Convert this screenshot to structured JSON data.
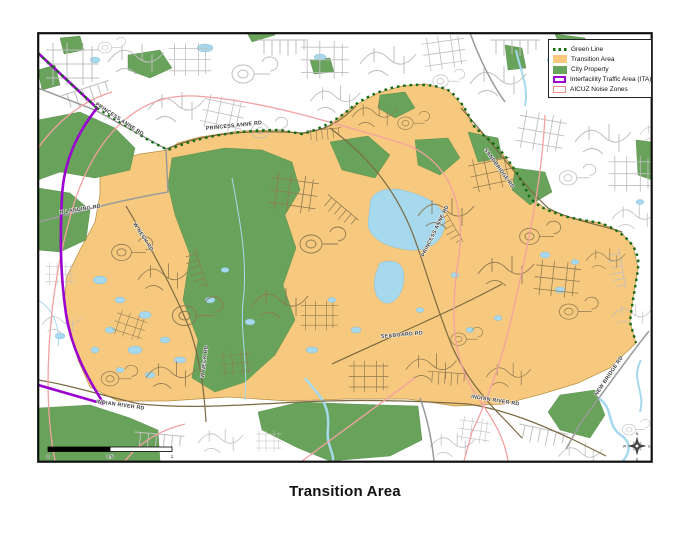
{
  "title": "Transition Area",
  "legend": {
    "items": [
      {
        "label": "Green Line",
        "type": "dotted-line",
        "color": "#146b14"
      },
      {
        "label": "Transition Area",
        "type": "fill",
        "color": "#F6C97E"
      },
      {
        "label": "City Property",
        "type": "fill",
        "color": "#69A35B"
      },
      {
        "label": "Interfacility Traffic Area (ITA)",
        "type": "outline",
        "color": "#9A00D0"
      },
      {
        "label": "AICUZ Noise Zones",
        "type": "outline",
        "color": "#F08E8E"
      }
    ]
  },
  "map": {
    "road_labels": [
      {
        "text": "PRINCESS ANNE RD"
      },
      {
        "text": "PRINCESS ANNE RD"
      },
      {
        "text": "PRINCESS ANNE RD"
      },
      {
        "text": "N LANDING RD"
      },
      {
        "text": "W NECK RD"
      },
      {
        "text": "W NECK RD"
      },
      {
        "text": "SANDBRIDGE RD"
      },
      {
        "text": "SEABOARD RD"
      },
      {
        "text": "INDIAN RIVER RD"
      },
      {
        "text": "INDIAN RIVER RD"
      },
      {
        "text": "NEW BRIDGE RD"
      }
    ],
    "scale_bar": {
      "start": "0",
      "mid": "0.5",
      "end": "1",
      "unit": "Miles"
    },
    "compass": {
      "n": "N",
      "e": "E",
      "s": "S",
      "w": "W"
    },
    "colors": {
      "transition_area": "#F6C97E",
      "city_property": "#69A35B",
      "green_line": "#146b14",
      "ita": "#9A00D0",
      "aicuz": "#F08E8E",
      "water": "#A6D9EE"
    }
  }
}
